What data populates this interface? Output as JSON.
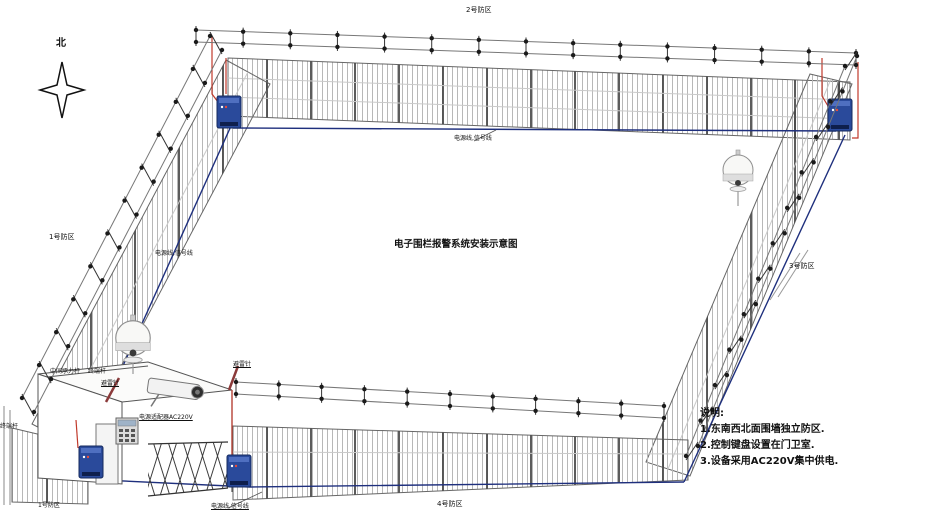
{
  "title": "电子围栏报警系统安装示意图",
  "compass": {
    "north_label": "北"
  },
  "zones": {
    "zone1": "1号防区",
    "zone2": "2号防区",
    "zone3": "3号防区",
    "zone4": "4号防区",
    "zone1_gate": "1号防区"
  },
  "labels": {
    "cable_top": "电源线,信号线",
    "cable_left": "电源线,信号线",
    "cable_bottom": "电源线,信号线",
    "power_adapter": "电源适配器AC220V",
    "mid_pole": "中间承力杆",
    "terminal_pole": "终端杆",
    "terminal_pole_left": "终端杆",
    "lightning_rod_gate": "避雷针",
    "lightning_rod_bottom": "避雷针"
  },
  "notes": {
    "heading": "说明:",
    "items": [
      "1.东南西北面围墙独立防区.",
      "2.控制键盘设置在门卫室.",
      "3.设备采用AC220V集中供电."
    ]
  },
  "colors": {
    "cable_blue": "#1e2f7d",
    "alarm_red": "#b03a2e",
    "controller_blue": "#2a4a9b"
  }
}
